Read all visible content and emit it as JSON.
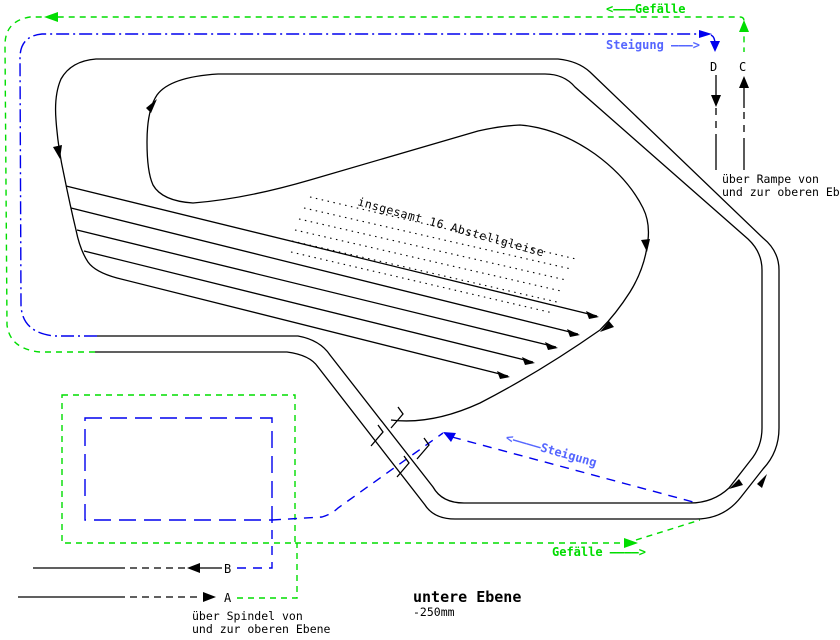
{
  "diagram": {
    "title": "untere Ebene",
    "elevation": "-250mm",
    "labels": {
      "gefaelle_top": "<———Gefälle",
      "steigung_top": "Steigung ———>",
      "steigung_mid": "<————Steigung",
      "gefaelle_bottom": "Gefälle ————>",
      "yard_note": "insgesamt 16 Abstellgleise",
      "ramp_note_line1": "über Rampe von",
      "ramp_note_line2": "und zur oberen Ebene",
      "spindle_note_line1": "über Spindel von",
      "spindle_note_line2": "und zur oberen Ebene",
      "point_a": "A",
      "point_b": "B",
      "point_c": "C",
      "point_d": "D"
    },
    "colors": {
      "track": "#000000",
      "gradient_down": "#00dd00",
      "gradient_up": "#0000ee",
      "steigung_text": "#5566ff"
    }
  }
}
